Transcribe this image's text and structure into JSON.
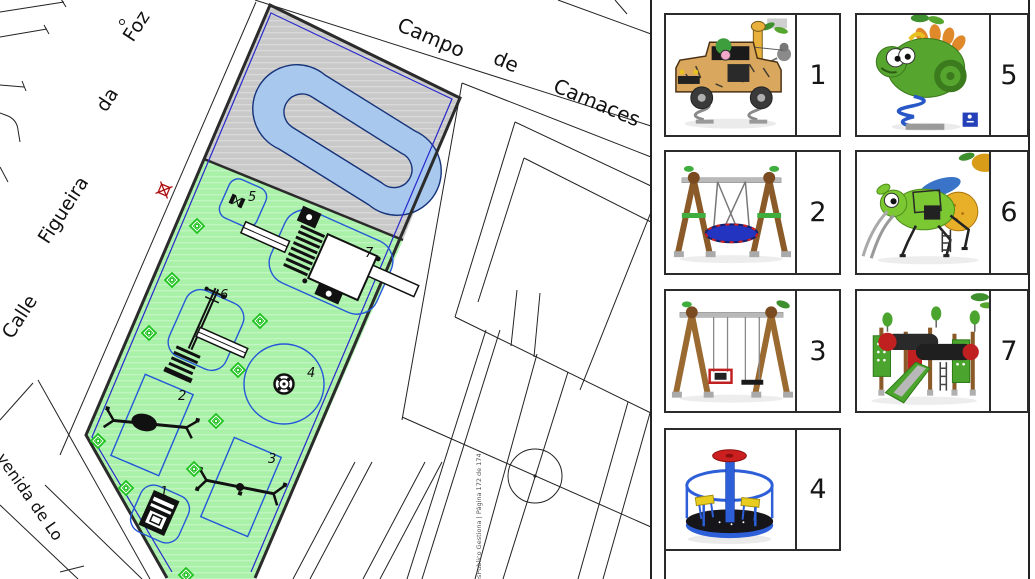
{
  "map": {
    "streets": {
      "top": [
        "Campo",
        "de",
        "Camaces"
      ],
      "left": [
        "Calle",
        "Figueira",
        "da",
        "Foz"
      ],
      "bottom": "venida  de  Lo"
    },
    "watermark": "esPublico Gestiona | Página 172 de 174",
    "zones": [
      {
        "num": "1",
        "icon": "spring-rider-car-plan"
      },
      {
        "num": "2",
        "icon": "rotating-swing-plan"
      },
      {
        "num": "3",
        "icon": "swing-plan"
      },
      {
        "num": "4",
        "icon": "merry-go-round-plan"
      },
      {
        "num": "5",
        "icon": "spring-rider-plan"
      },
      {
        "num": "6",
        "icon": "climber-plan"
      },
      {
        "num": "7",
        "icon": "play-structure-plan"
      }
    ],
    "colors": {
      "green_area": "#a9f1a9",
      "paved_area": "#c9c9c9",
      "zone_outline": "#2458d8",
      "parcel_line": "#2828cc",
      "water_loop": "#a8c8ee",
      "lamp": "#1ec21e",
      "marker": "#b01010"
    }
  },
  "panel": {
    "items": [
      {
        "num": "1",
        "icon": "safari-jeep-spring-rider"
      },
      {
        "num": "5",
        "icon": "chameleon-spring-rider"
      },
      {
        "num": "2",
        "icon": "nest-swing"
      },
      {
        "num": "6",
        "icon": "grasshopper-climber"
      },
      {
        "num": "3",
        "icon": "double-swing"
      },
      {
        "num": "7",
        "icon": "play-structure-with-slide"
      },
      {
        "num": "4",
        "icon": "merry-go-round"
      }
    ]
  }
}
